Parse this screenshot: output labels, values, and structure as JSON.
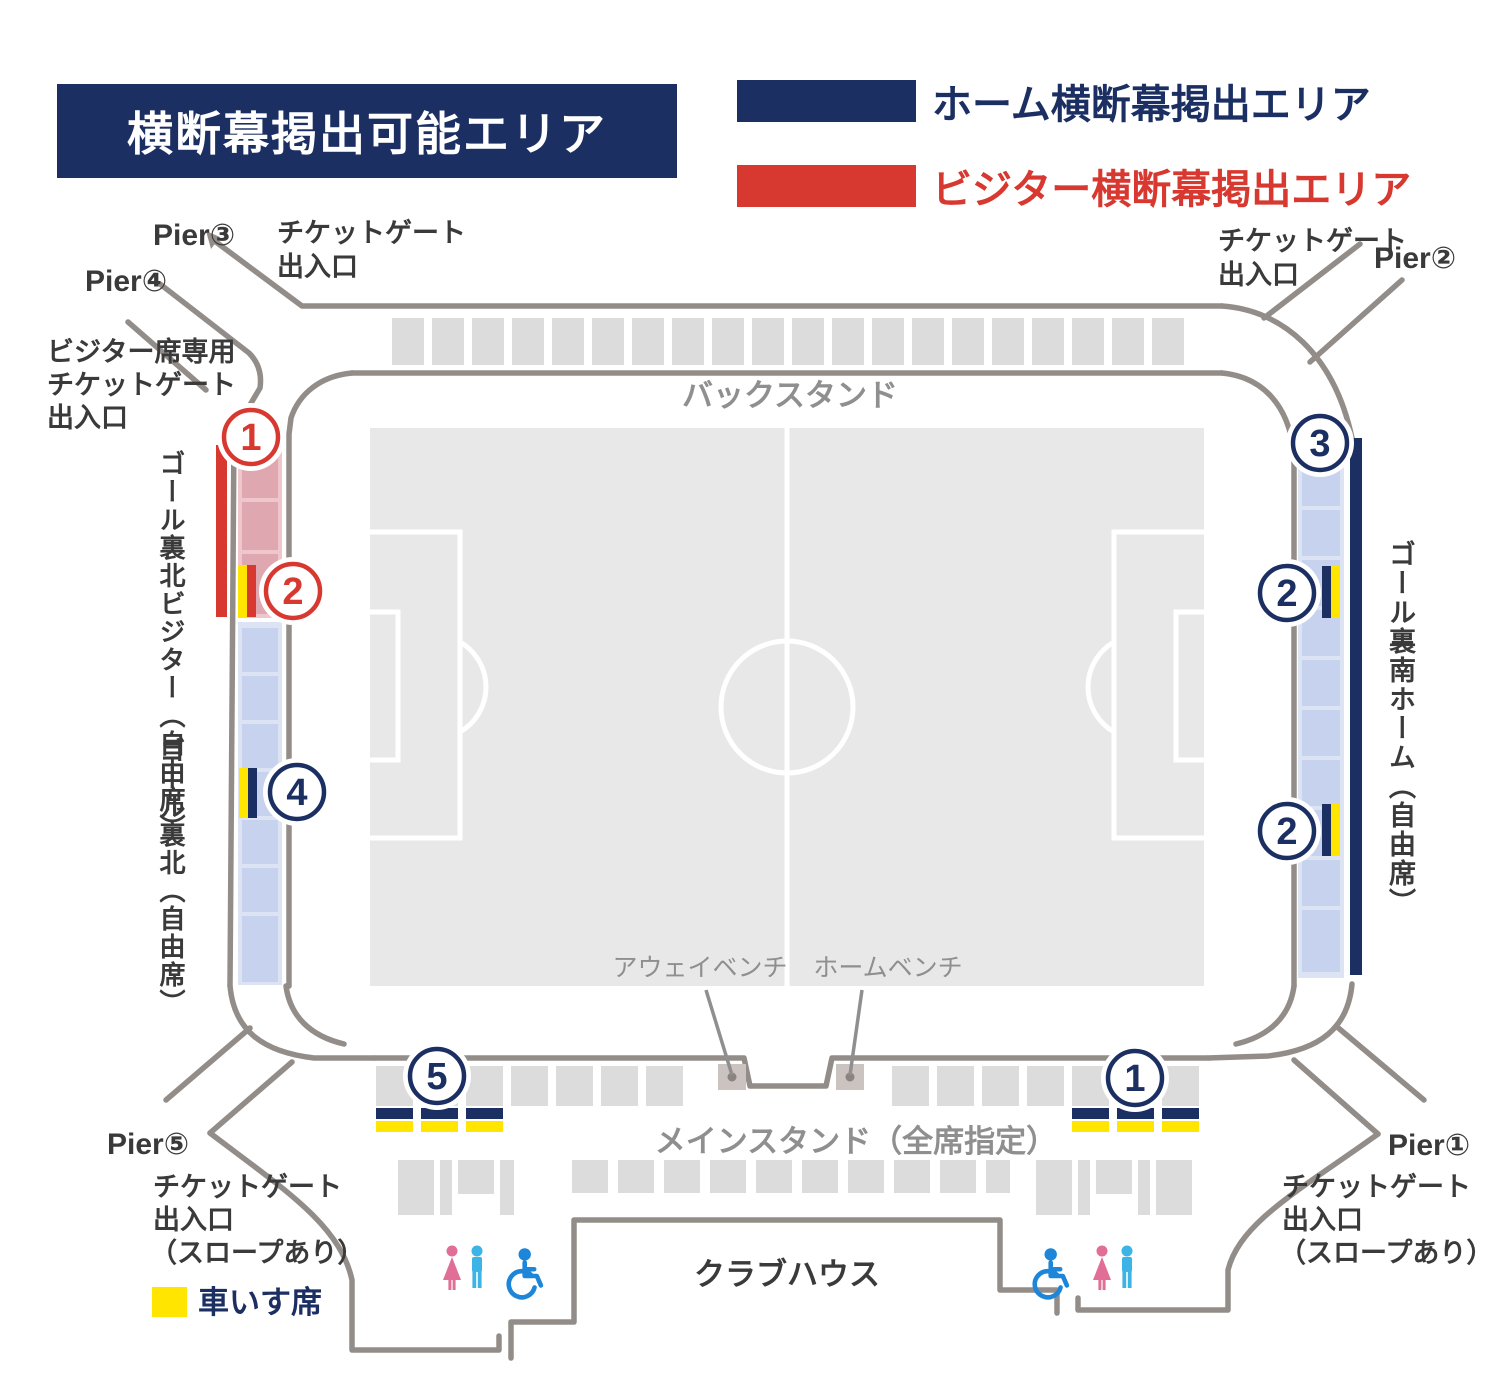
{
  "title": "横断幕掲出可能エリア",
  "legend": {
    "home_label": "ホーム横断幕掲出エリア",
    "visitor_label": "ビジター横断幕掲出エリア"
  },
  "stands": {
    "back": "バックスタンド",
    "main": "メインスタンド（全席指定）",
    "north_visitor_vertical": "ゴール裏北ビジター（自由席）",
    "north_vertical": "ゴール裏北（自由席）",
    "south_home_vertical": "ゴール裏南ホーム（自由席）"
  },
  "benches": {
    "away": "アウェイベンチ",
    "home": "ホームベンチ"
  },
  "piers": {
    "p1": "Pier①",
    "p2": "Pier②",
    "p3": "Pier③",
    "p4": "Pier④",
    "p5": "Pier⑤"
  },
  "gates": {
    "ticket_line1": "チケットゲート",
    "ticket_line2": "出入口",
    "slope_note": "（スロープあり）",
    "visitor_line1": "ビジター席専用",
    "visitor_line2": "チケットゲート",
    "visitor_line3": "出入口"
  },
  "facility": {
    "clubhouse": "クラブハウス",
    "wheelchair_seat_label": "車いす席"
  },
  "markers": {
    "visitor": [
      {
        "n": "1"
      },
      {
        "n": "2"
      }
    ],
    "home": [
      {
        "n": "3"
      },
      {
        "n": "2"
      },
      {
        "n": "2"
      },
      {
        "n": "4"
      },
      {
        "n": "5"
      },
      {
        "n": "1"
      }
    ]
  },
  "colors": {
    "navy": "#1c2f63",
    "red": "#d7382f",
    "yellow": "#ffe500",
    "pinkBg": "#eec6cb",
    "pinkBlock": "#dfa8b0",
    "blueBg": "#dce3f3",
    "blueBlock": "#c7d3ee",
    "grayBlock": "#dcdcdc",
    "pitch": "#e9e8e8",
    "outline": "#938d89",
    "labelGray": "#8f8f8f",
    "bench": "#cac3bf",
    "female": "#e06e96",
    "male": "#3cb4e5",
    "wheelchair": "#1d86d8"
  }
}
